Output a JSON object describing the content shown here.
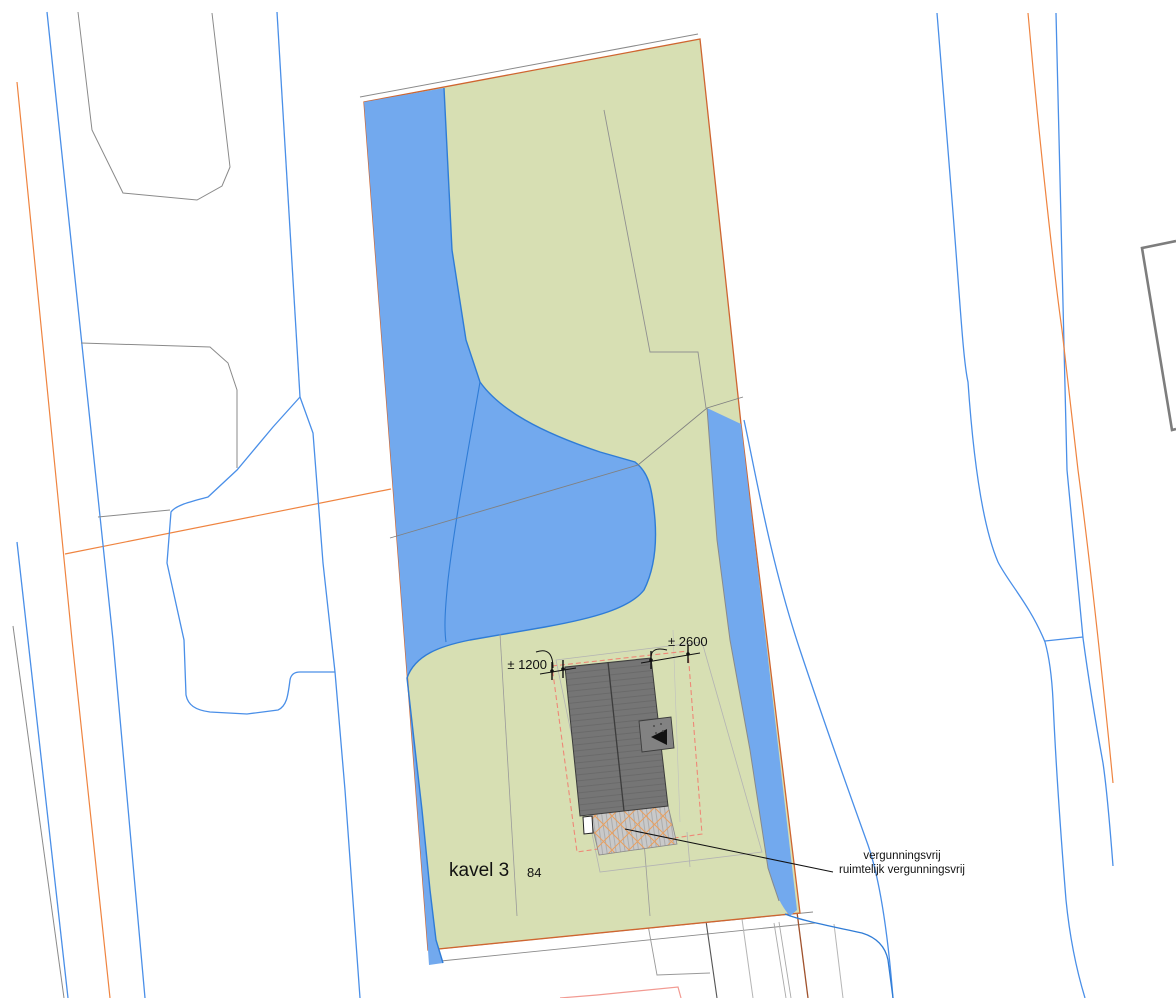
{
  "drawing_type": "cadastral-site-plan",
  "labels": {
    "plot": "kavel 3",
    "parcel_number": "84"
  },
  "dimensions": {
    "left": "± 1200",
    "right": "± 2600"
  },
  "annotation": {
    "line1": "vergunningsvrij",
    "line2": "ruimtelijk vergunningsvrij"
  },
  "colors": {
    "parcel_fill": "#d7dfb3",
    "water_fill": "#72a9ee",
    "water_line": "#2f7cd6",
    "line_blue": "#4a8fe8",
    "line_orange": "#ef8440",
    "parcel_border": "#cf6530",
    "zone_dashed": "#ee8877",
    "roof_fill": "#757575",
    "roof_edge": "#3c3c3c",
    "terrace_fill": "#c9c9c9",
    "terrace_cross": "#e8a060",
    "gray_line": "#8a8a8a",
    "pink_line": "#f29a92",
    "brown_line": "#a0522d",
    "text": "#111111"
  }
}
